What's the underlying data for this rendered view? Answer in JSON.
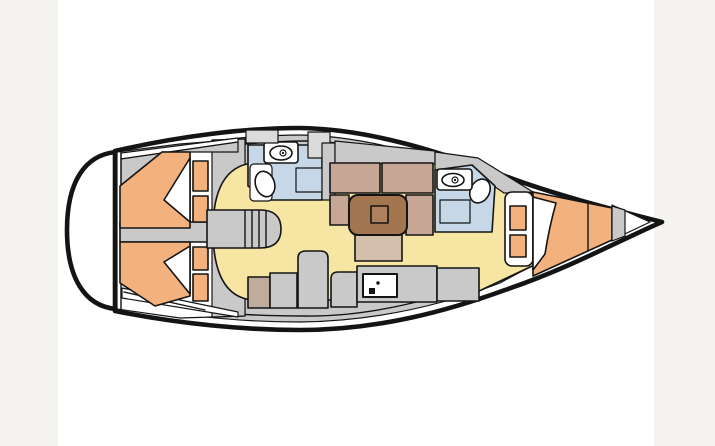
{
  "page": {
    "background": "#ffffff",
    "margin_color": "#f5f3f0"
  },
  "diagram": {
    "type": "boat-floor-plan",
    "subject": "sailing yacht interior layout, top view, bow pointing right",
    "regions": [
      {
        "id": "swim-platform",
        "label": "stern swim platform"
      },
      {
        "id": "aft-cabin-top",
        "label": "aft double cabin with berth and pillow (top)"
      },
      {
        "id": "aft-cabin-bottom",
        "label": "aft double cabin with berth and pillow (bottom)"
      },
      {
        "id": "companionway-steps",
        "label": "companionway steps"
      },
      {
        "id": "head-amidships",
        "label": "amidships head with toilet, wash basin and shower tray"
      },
      {
        "id": "salon-dinette",
        "label": "salon dinette with settee, bench and table"
      },
      {
        "id": "galley",
        "label": "galley counters with stove"
      },
      {
        "id": "head-forward",
        "label": "forward head with toilet, wash basin and shower tray"
      },
      {
        "id": "forward-cabin",
        "label": "forward V-berth cabin with steps"
      },
      {
        "id": "bow",
        "label": "bow tip"
      }
    ]
  },
  "colors": {
    "line": "#141414",
    "hull_fill": "#ffffff",
    "deck": "#c9c9c9",
    "deck_light": "#dbdbdb",
    "floor": "#f6e5a3",
    "bed": "#f3b27d",
    "wet_room": "#c6d8e7",
    "seat": "#c8a695",
    "seat_light": "#d4bfad",
    "table": "#a3764f",
    "table_inner": "#b0815f",
    "counter_tan": "#bfac9a",
    "fixture": "#ffffff",
    "ink": "#111111"
  }
}
